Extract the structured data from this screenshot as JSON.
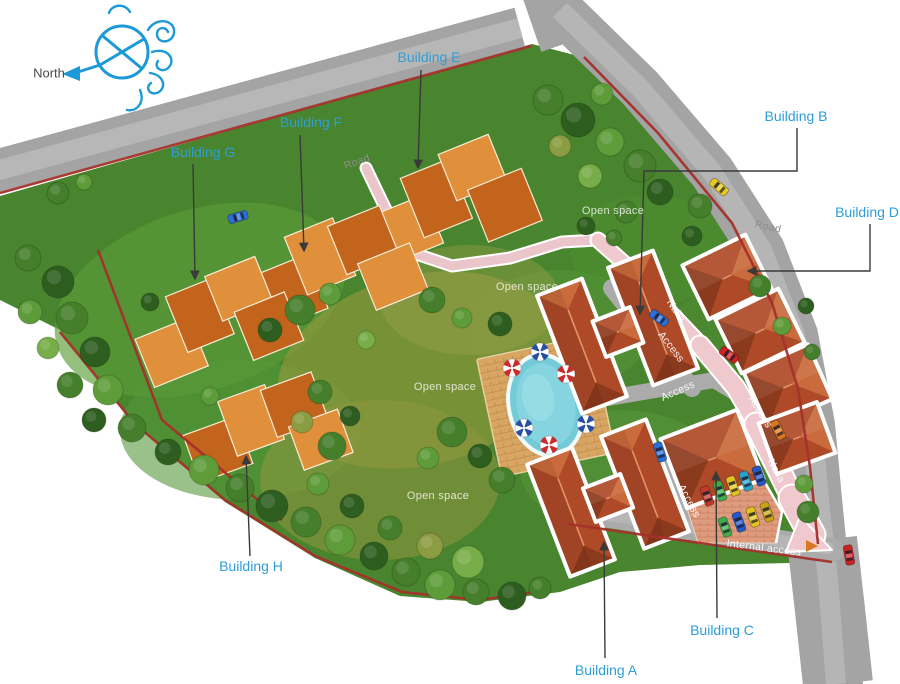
{
  "compass": {
    "label": "North"
  },
  "buildings": [
    {
      "id": "A",
      "label": "Building A"
    },
    {
      "id": "B",
      "label": "Building B"
    },
    {
      "id": "C",
      "label": "Building C"
    },
    {
      "id": "D",
      "label": "Building D"
    },
    {
      "id": "E",
      "label": "Building E"
    },
    {
      "id": "F",
      "label": "Building F"
    },
    {
      "id": "G",
      "label": "Building G"
    },
    {
      "id": "H",
      "label": "Building H"
    }
  ],
  "ground_labels": {
    "road_top": "Road",
    "road_right": "Road",
    "open_space_1": "Open space",
    "open_space_2": "Open space",
    "open_space_3": "Open space",
    "open_space_4": "Open space",
    "access_1": "Access",
    "access_2": "Access",
    "access_3": "Access",
    "access_4": "Access",
    "nalla_1": "Nalla",
    "nalla_2": "Nalla",
    "internal_access": "Internal access"
  },
  "colors": {
    "label_blue": "#2D9ED9",
    "compass_blue": "#1C9AD7",
    "road_gray": "#A6A6A6",
    "boundary_red": "#A5312A",
    "nalla_pink": "#EFC9CE",
    "grass_green": "#49842E",
    "roof_orange_dark": "#C2641C",
    "roof_orange_light": "#E08F3A",
    "roof_red": "#AE4A28",
    "pool_blue": "#74CBD8"
  }
}
